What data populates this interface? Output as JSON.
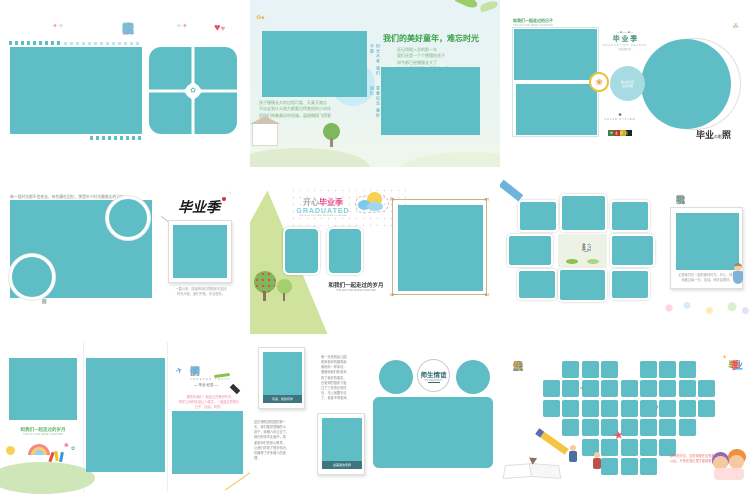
{
  "page": {
    "title": "毕业季相册模板合集",
    "grid": "3x3"
  },
  "colors": {
    "teal": "#5fbdc5",
    "light_teal": "#c9ecf6",
    "teal_circle": "#a7dbe2",
    "green_wedge": "#cfe39c",
    "pink_accent": "#e0518e",
    "caption_bar": "#3e7680"
  },
  "t1": {
    "title_chars": [
      {
        "ch": "我",
        "c": "#6cc5d6"
      },
      {
        "ch": "们",
        "c": "#f298b8"
      },
      {
        "ch": "毕",
        "c": "#5fbdc5"
      },
      {
        "ch": "业",
        "c": "#b79bd8"
      },
      {
        "ch": "啦",
        "c": "#6cc5d6"
      }
    ]
  },
  "t2": {
    "title": "我们的美好童年，难忘时光",
    "paragraph": "还记得刚入学的那一年\n我们还是一个个懵懂的孩子\n如今都已经慢慢长大了\n小学生活即将画上圆满的句号",
    "vtext1": "时光不老 我们不散",
    "vtext2": "青春纪念 美好回忆",
    "bottom_text": "孩子慢慢长大的过程可爱、天真又难忘\n不论走到什么地方都要记得曾经的小伙伴\n愿你们带着美好的祝福，展翅翱翔飞得更高"
  },
  "t3": {
    "corner_title": "和我们一起走过的日子",
    "corner_sub": "THE DAYS WE WERE TOGETHER",
    "logo_title": "毕 业 季",
    "logo_sub": "GRADUATION SEASON",
    "logo_sub2": "“ 相遇便是缘 ”",
    "circle_text": "美好的回忆\n值得珍藏",
    "footer_brand": "SOLAR SYSTEM",
    "footer_badge": "毕业纪念",
    "caption_parts": [
      "毕业",
      "の影",
      "照"
    ]
  },
  "t4": {
    "top_text": "每一段时光都不会老去，有些藏在回忆，那是年少时光最难忘的记忆。",
    "calligraphy": "毕业季",
    "bottom_chars": [
      {
        "ch": "致",
        "c": "#8ed0dd"
      },
      {
        "ch": "我",
        "c": "#8ed0dd"
      },
      {
        "ch": "们",
        "c": "#8ed0dd"
      },
      {
        "ch": "最",
        "c": "#f5a623"
      },
      {
        "ch": "美",
        "c": "#f0739c"
      },
      {
        "ch": "的",
        "c": "#8ed0dd"
      },
      {
        "ch": "毕",
        "c": "#7bc8d8"
      },
      {
        "ch": "业",
        "c": "#f5a623"
      },
      {
        "ch": "季",
        "c": "#8ed0dd"
      }
    ],
    "caption": "一直以来，感谢有你们的陪伴与支持\n时光不老，我们不散，毕业快乐。"
  },
  "t5": {
    "title_gray": "开心",
    "title_pink": "毕业季",
    "subtitle": "GRADUATED",
    "tagline": "THE GOOD OLD DAYS WE SPENT TOGETHER",
    "center_title": "和我们一起走过的岁月",
    "center_sub": "THE DAYS WE WERE TOGETHER"
  },
  "t6": {
    "title_chars": [
      {
        "ch": "我",
        "c": "#e8503a"
      },
      {
        "ch": "毕",
        "c": "#f59d2c"
      },
      {
        "ch": "业",
        "c": "#f5bf2c"
      },
      {
        "ch": "啦",
        "c": "#4b9fd8"
      }
    ],
    "center_chars": [
      {
        "ch": "毕",
        "c": "#ffffff"
      },
      {
        "ch": "业",
        "c": "#ffffff"
      },
      {
        "ch": "季",
        "c": "#ffffff"
      },
      {
        "ch": "!",
        "c": "#f39c12"
      }
    ],
    "caption": "记录我们在一起的美好时光，开心、快乐\n地度过每一天，加油，明天会更好。"
  },
  "t7": {
    "p1_text": "和我们一起走过的岁月",
    "p1_sub": "THE DAYS WE WERE TOGETHER",
    "title_chars": [
      {
        "ch": "同",
        "c": "#f06e8e"
      },
      {
        "ch": "学",
        "c": "#8bc34a"
      },
      {
        "ch": "情",
        "c": "#64b5f6"
      }
    ],
    "sub1": "FOREVER YOUTH",
    "sub2": "— 毕业·纪念 —",
    "pink_text": "那些年我们一起走过的美好时光\n同学之间的情谊让人难忘，一起度过的快乐日子，加油，同学。"
  },
  "t8": {
    "caption1": "同桌，我的同学",
    "caption2": "最美丽的老师",
    "para_left": "还记得刚进校园的那一\n天，我们都是懵懂的小\n孩子，转眼六年过去了，\n我们即将毕业离开，感\n谢老师们的悉心教导，\n让我们学到了很多知识，\n也懂得了许多做人的道\n理。",
    "para_top": "第一天来到幼儿园\n看到老师的微笑就\n像妈妈一样亲切，\n慢慢地我们和老师\n成了最好的朋友，\n在老师的陪伴下度\n过了三年快乐的时\n光，马上就要毕业\n了，真舍不得老师。",
    "center_title": "师生情谊",
    "center_sub": "记忆中最美好的时光"
  },
  "t9": {
    "title_chars": [
      {
        "ch": "快",
        "c": "#e74c3c"
      },
      {
        "ch": "乐",
        "c": "#4caf50"
      },
      {
        "ch": "童",
        "c": "#3f8fd2"
      },
      {
        "ch": "年",
        "c": "#f5a623"
      }
    ],
    "vertical_chars": [
      {
        "ch": "毕",
        "c": "#8bc34a"
      },
      {
        "ch": "业",
        "c": "#42a5f5"
      },
      {
        "ch": "季",
        "c": "#ef5350"
      }
    ],
    "red_text": "那时的天空，总觉得现在没有那时候的蓝\n以后，只有在回忆里才能够看见……",
    "heart_rows": [
      [
        1,
        2,
        3,
        5,
        6,
        7
      ],
      [
        0,
        1,
        2,
        3,
        4,
        5,
        6,
        7,
        8
      ],
      [
        0,
        1,
        2,
        3,
        4,
        5,
        6,
        7,
        8
      ],
      [
        1,
        2,
        3,
        4,
        5,
        6,
        7
      ],
      [
        2,
        3,
        4,
        5,
        6
      ],
      [
        3,
        4,
        5
      ]
    ]
  }
}
